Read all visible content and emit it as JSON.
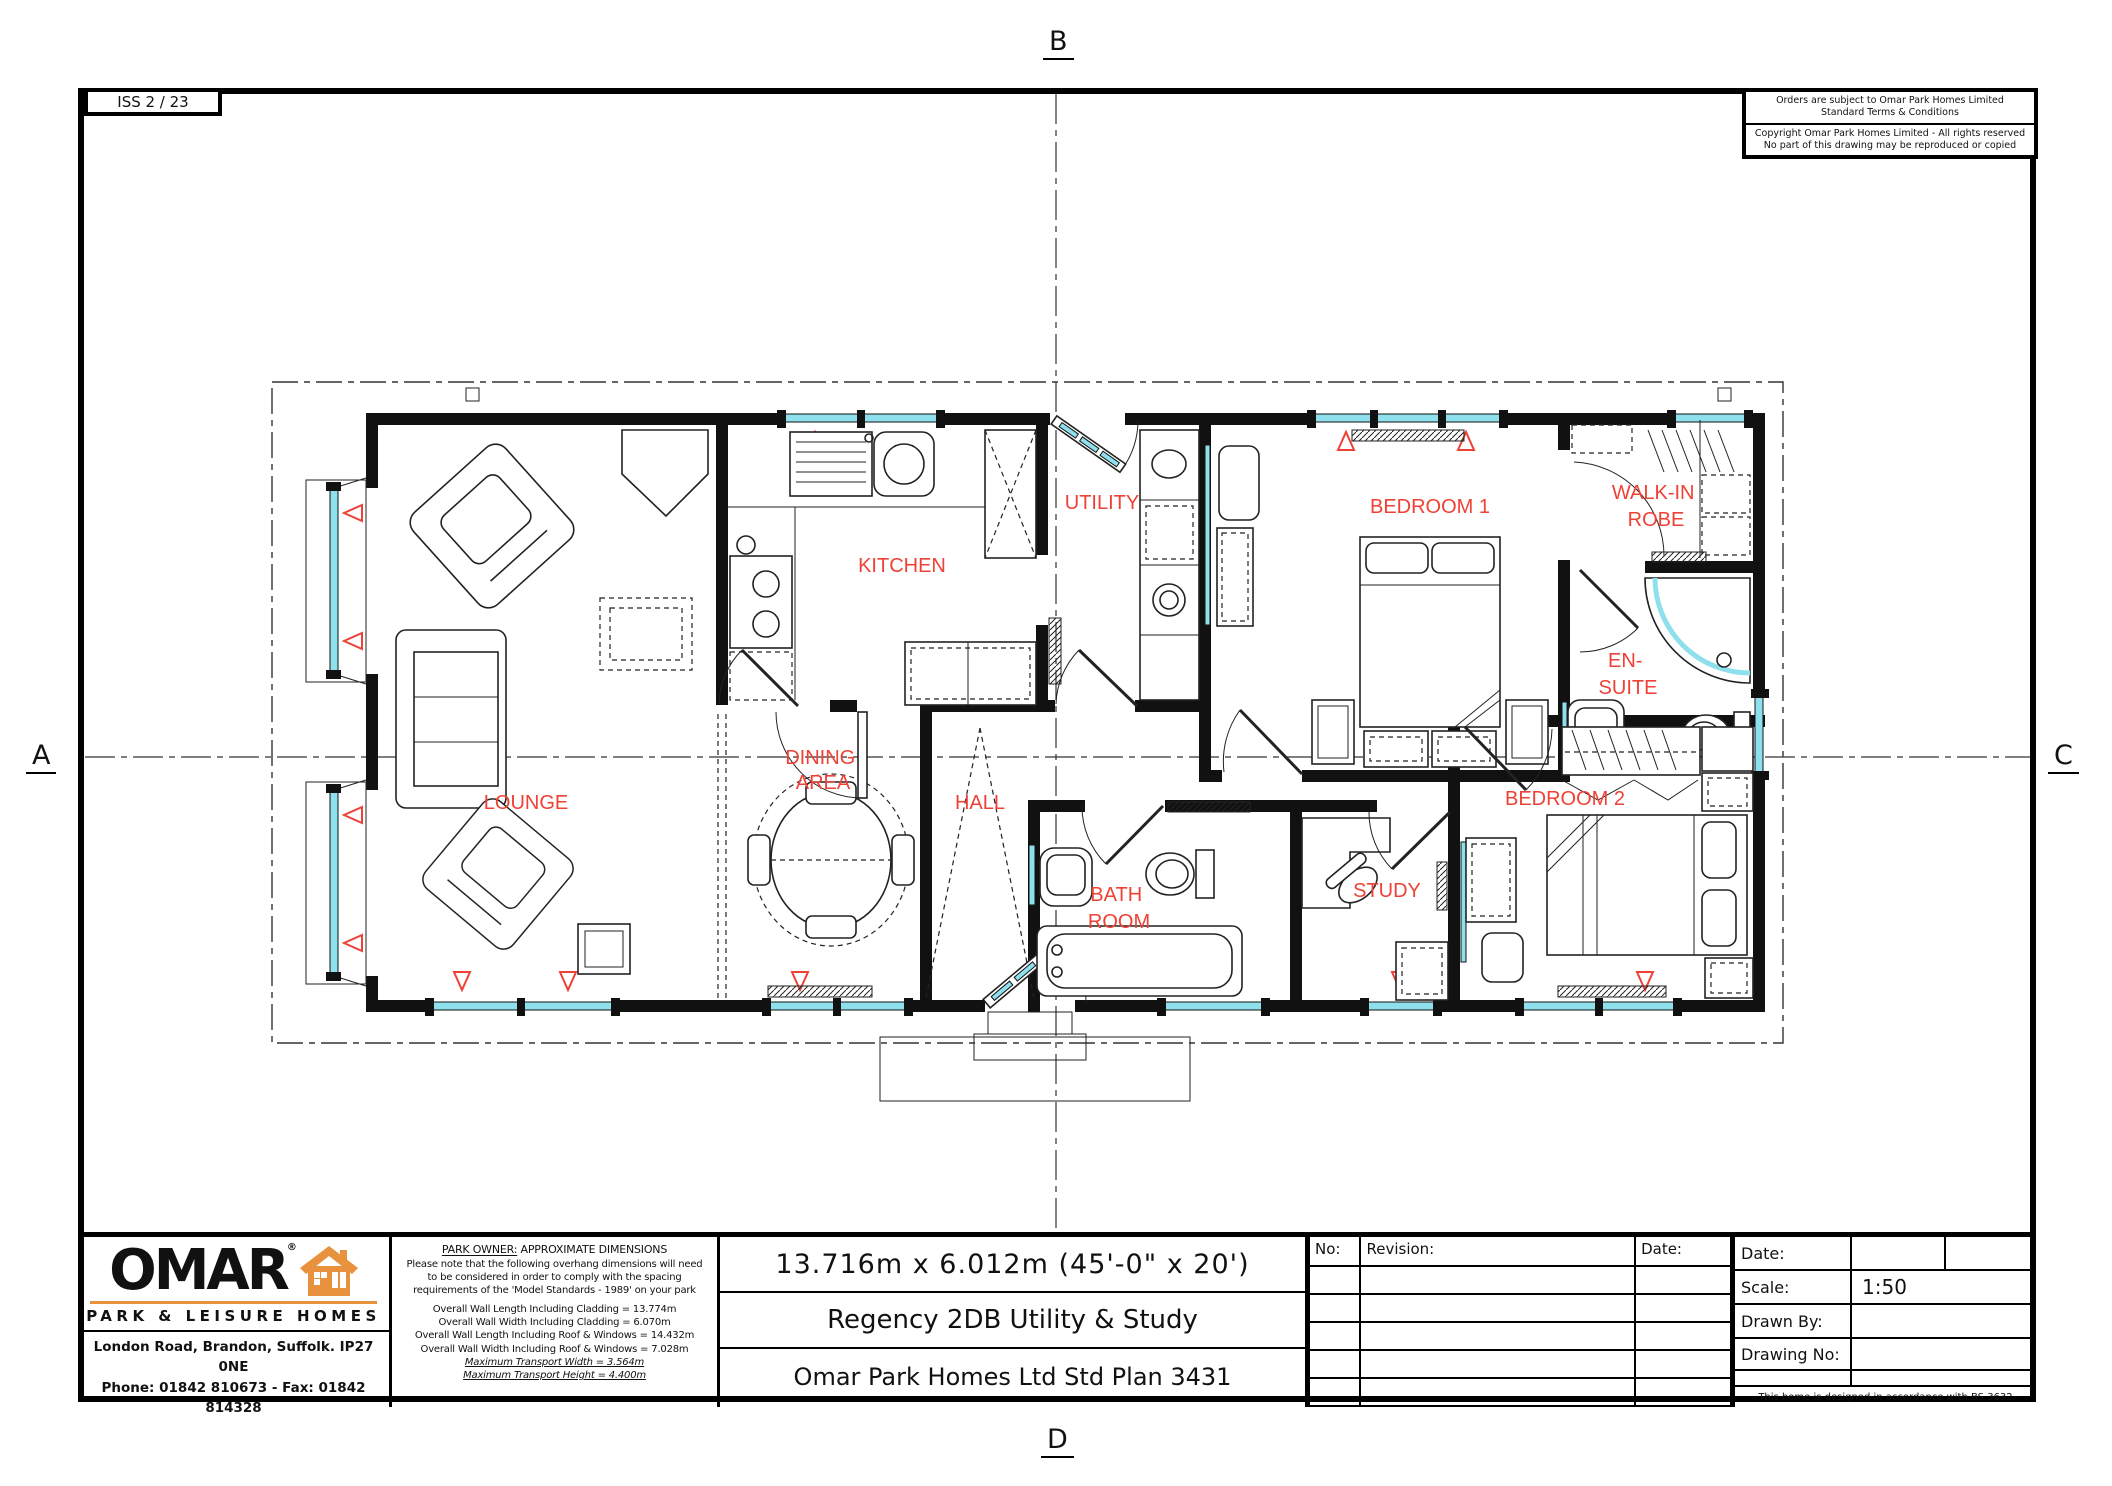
{
  "colors": {
    "wall_black": "#111111",
    "glazing_cyan": "#8fe0ed",
    "label_red": "#ef4136",
    "brand_orange": "#e8923e"
  },
  "sheet": {
    "iss_label": "ISS 2 / 23",
    "markers": {
      "top": "B",
      "left": "A",
      "right": "C",
      "bottom": "D"
    },
    "terms_box": {
      "line1": "Orders are subject to Omar Park Homes Limited",
      "line2": "Standard Terms & Conditions"
    },
    "copyright_box": {
      "line1": "Copyright Omar Park Homes Limited - All rights reserved",
      "line2": "No part of this drawing may be reproduced or copied"
    }
  },
  "plan": {
    "rooms": [
      {
        "id": "lounge",
        "line1": "LOUNGE"
      },
      {
        "id": "kitchen",
        "line1": "KITCHEN"
      },
      {
        "id": "utility",
        "line1": "UTILITY"
      },
      {
        "id": "dining-area",
        "line1": "DINING",
        "line2": "AREA"
      },
      {
        "id": "hall",
        "line1": "HALL"
      },
      {
        "id": "bathroom",
        "line1": "BATH",
        "line2": "ROOM"
      },
      {
        "id": "study",
        "line1": "STUDY"
      },
      {
        "id": "bedroom-1",
        "line1": "BEDROOM 1"
      },
      {
        "id": "walk-in-robe",
        "line1": "WALK-IN",
        "line2": "ROBE"
      },
      {
        "id": "en-suite",
        "line1": "EN-",
        "line2": "SUITE"
      },
      {
        "id": "bedroom-2",
        "line1": "BEDROOM 2"
      }
    ]
  },
  "title_block": {
    "logo": {
      "brand": "OMAR",
      "reg_mark": "®",
      "tagline": "PARK & LEISURE HOMES",
      "address": "London Road, Brandon, Suffolk. IP27 0NE",
      "phone_fax": "Phone: 01842 810673 - Fax: 01842 814328"
    },
    "park_owner": {
      "heading_underlined": "PARK OWNER:",
      "heading_rest": " APPROXIMATE DIMENSIONS",
      "body_lines": [
        "Please note that the following overhang dimensions will need",
        "to be considered in order to comply with the spacing",
        "requirements of the 'Model Standards - 1989' on your park"
      ],
      "dimension_lines": [
        "Overall Wall Length Including Cladding = 13.774m",
        "Overall Wall Width Including Cladding = 6.070m",
        "Overall Wall Length Including Roof & Windows = 14.432m",
        "Overall Wall Width Including Roof & Windows = 7.028m"
      ],
      "transport_lines": [
        "Maximum Transport Width = 3.564m",
        "Maximum Transport Height = 4.400m"
      ]
    },
    "titles": {
      "dimensions": "13.716m x 6.012m (45'-0\" x 20')",
      "model": "Regency 2DB Utility & Study",
      "plan_no": "Omar Park Homes Ltd Std Plan 3431"
    },
    "revision_table": {
      "no_label": "No:",
      "revision_label": "Revision:",
      "date_label": "Date:"
    },
    "info": {
      "date_label": "Date:",
      "scale_label": "Scale:",
      "scale_value": "1:50",
      "drawn_by_label": "Drawn By:",
      "drawing_no_label": "Drawing No:",
      "standard_note": "This home is designed in accordance with BS.3632"
    }
  }
}
